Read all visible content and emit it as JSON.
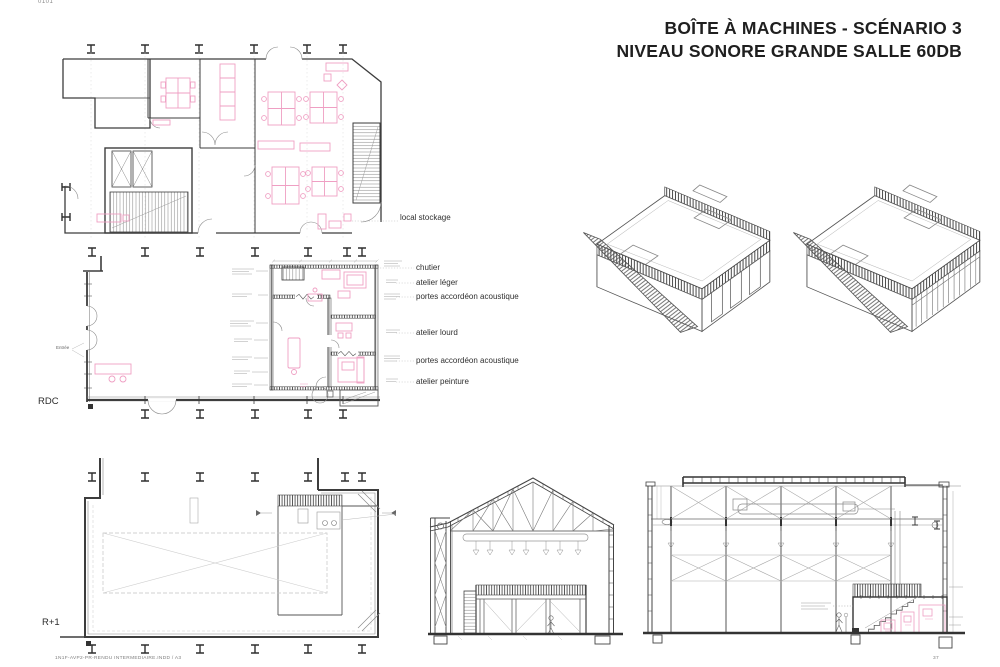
{
  "page": {
    "sheet_number": "0101",
    "title_line1": "BOÎTE À MACHINES - SCÉNARIO 3",
    "title_line2": "NIVEAU SONORE GRANDE SALLE 60DB",
    "footer_left": "1N1F-AVP2-PR-RENDU INTERMEDIAIRE.INDD / A3",
    "footer_page": "37"
  },
  "floor_labels": {
    "ground": "RDC",
    "upper": "R+1"
  },
  "plan_annotations": {
    "entrance": "Entrée",
    "items": [
      {
        "label": "local stockage"
      },
      {
        "label": "chutier"
      },
      {
        "label": "atelier léger"
      },
      {
        "label": "portes accordéon acoustique"
      },
      {
        "label": "atelier lourd"
      },
      {
        "label": "portes accordéon acoustique"
      },
      {
        "label": "atelier peinture"
      }
    ]
  },
  "colors": {
    "furniture_pink": "#ef9fc3",
    "line_dark": "#3c3c3c",
    "line_light": "#9a9a9a"
  }
}
